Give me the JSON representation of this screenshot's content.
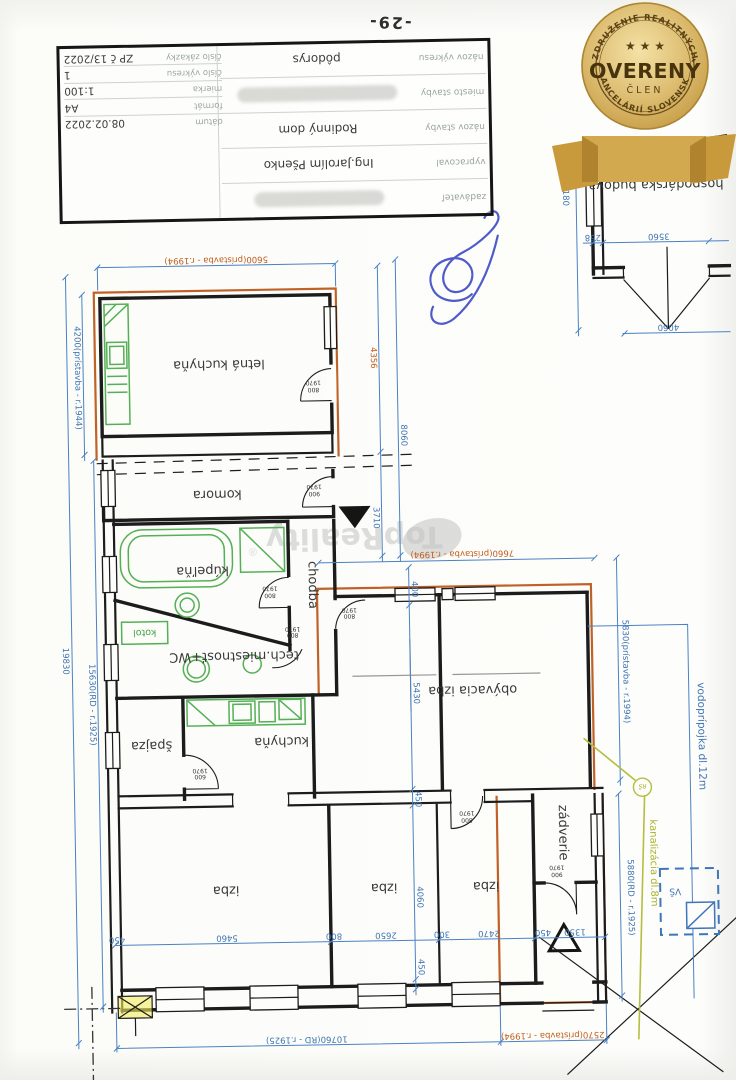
{
  "page": {
    "number": "-29-"
  },
  "title_block": {
    "rows": [
      {
        "label": "zadávateľ",
        "value": ""
      },
      {
        "label": "vypracoval",
        "value": "Ing.Jarolím Pšenko"
      },
      {
        "label": "názov stavby",
        "value": "Rodinný dom"
      },
      {
        "label": "miesto stavby",
        "value": ""
      },
      {
        "label": "názov výkresu",
        "value": "pôdorys"
      }
    ],
    "fields": [
      {
        "label": "dátum",
        "value": "08.02.2022"
      },
      {
        "label": "formát",
        "value": "A4"
      },
      {
        "label": "mierka",
        "value": "1:100"
      },
      {
        "label": "číslo výkresu",
        "value": "1"
      },
      {
        "label": "číslo zákazky",
        "value": "ZP č 13/2022"
      }
    ]
  },
  "badge": {
    "arc_top": "ZDRUŽENIE REALITNÝCH",
    "arc_bottom": "KANCELÁRIÍ SLOVENSKA",
    "title": "OVERENÝ",
    "subtitle": "ČLEN",
    "stars": "★ ★ ★"
  },
  "watermark": {
    "text": "TopReality",
    "reg": "®"
  },
  "outbuilding": {
    "name": "hospodárska budova",
    "year": "c.1972",
    "dim_side": "12180",
    "dim_wall": "258",
    "dim_door": "3560",
    "dim_width": "4060"
  },
  "rooms": {
    "letna": "letná kuchyňa",
    "komora": "komora",
    "kupelna": "kúpeľňa",
    "chodba": "chodba",
    "tech": "tech.miestnosť+WC",
    "kotol": "kotol",
    "spajza": "špajza",
    "kuchyna": "kuchyňa",
    "obyvacia": "obývacia izba",
    "izba": "izba",
    "zadverie": "zádverie"
  },
  "doors": {
    "w600": "600",
    "w800": "800",
    "w900": "900",
    "h": "1970"
  },
  "dims": {
    "d5600": "5600(prístavba - r.1994)",
    "d4200": "4200(prístavba - r.1944)",
    "d4356": "4356",
    "d8060": "8060",
    "d3710": "3710",
    "d7660": "7660(prístavba - r.1994)",
    "d400": "400",
    "d5430": "5430",
    "d19830": "19830",
    "d15630": "15630(RD - r.1925)",
    "d450": "450",
    "d5460": "5460",
    "d800": "800",
    "d300": "300",
    "d2650": "2650",
    "d2470": "2470",
    "d1350": "1350",
    "d4060": "4060",
    "d5830": "5830(prístavba - r.1994)",
    "d5880": "5880(RD - r.1925)",
    "d10760": "10760(RD - r.1925)",
    "d2570": "2570(prístavba - r.1994)",
    "d12180": "12180",
    "d258": "258",
    "d3560": "3560"
  },
  "utils": {
    "water": "vodoprípojka dl.12m",
    "sewer": "kanalizácia dl.8m",
    "vs": "VŠ",
    "rs": "RŠ"
  }
}
